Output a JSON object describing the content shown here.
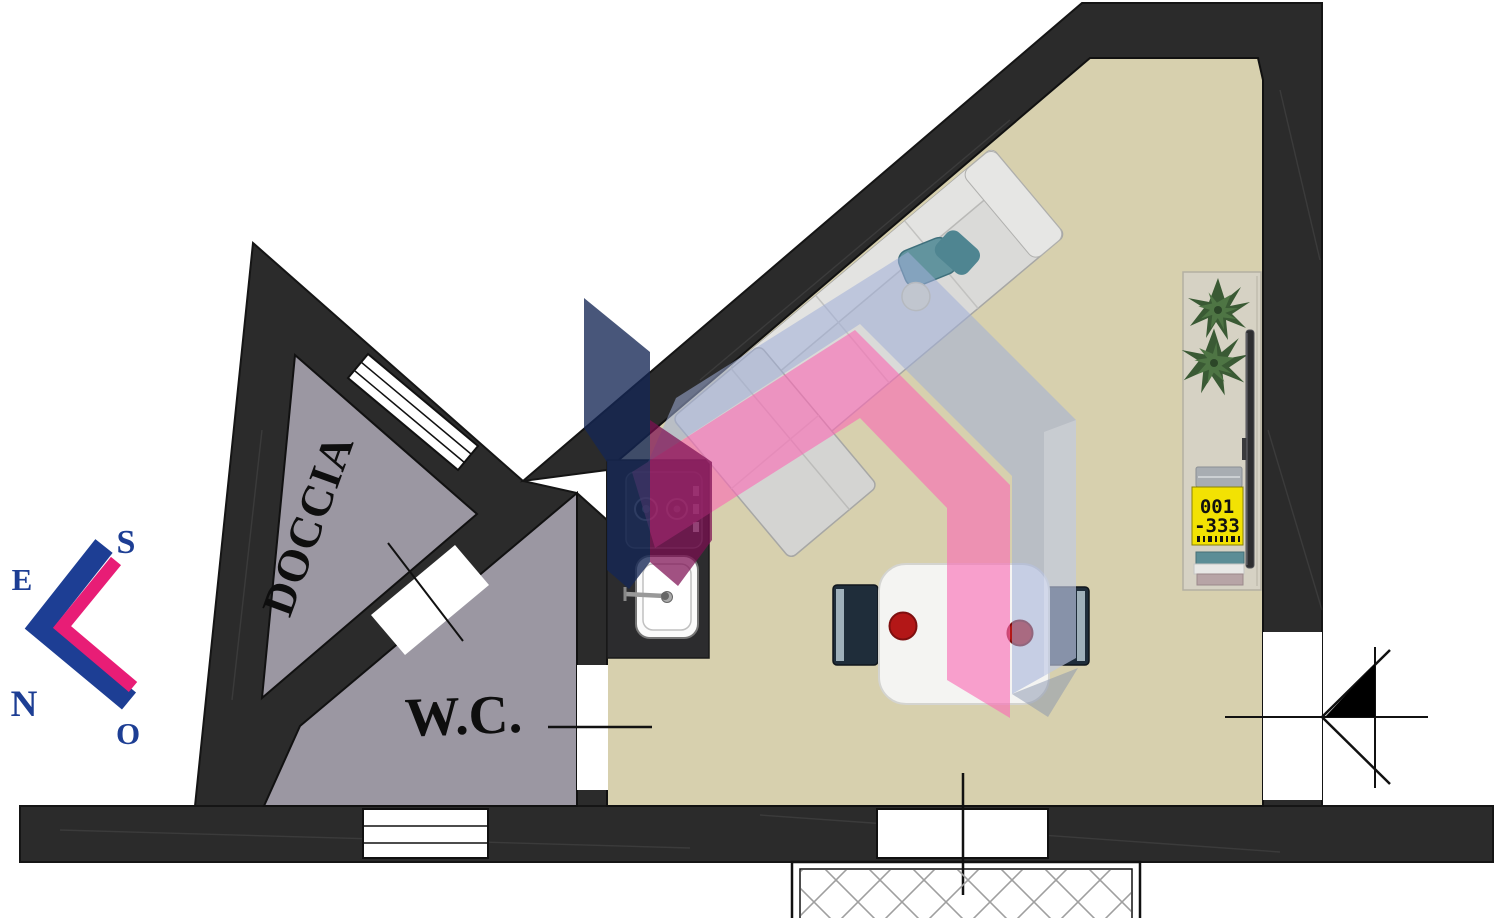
{
  "plan": {
    "type": "apartment floor plan",
    "rooms": {
      "shower_label": "DOCCIA",
      "wc_label": "W.C."
    },
    "compass": {
      "east": "E",
      "south": "S",
      "north": "N",
      "west": "O"
    },
    "sideboard_tag": {
      "line1": "001",
      "line2": "-333"
    }
  },
  "colors": {
    "background": "#ffffff",
    "wall": "#2b2b2b",
    "floor_main": "#d7d0ae",
    "floor_wet": "#9b97a2",
    "opening_white": "#ffffff",
    "outline": "#111111",
    "brand_blue": "#1d3e94",
    "brand_pink": "#e81d76",
    "watermark_gray": "#a0afd8",
    "watermark_pink": "#fa6ab4",
    "watermark_navy": "#142655",
    "watermark_magenta": "#7d0e52",
    "counter_dark": "#2c2c2e",
    "sofa_gray": "#dadad8",
    "table_white": "#f4f4f2",
    "plate_red": "#b31717",
    "chair_dark": "#1f2d3a",
    "sideboard_beige": "#d6d2c4",
    "plant_green": "#3a5a34",
    "tag_yellow": "#f2e203",
    "hatch_gray": "#9f9f9f"
  }
}
